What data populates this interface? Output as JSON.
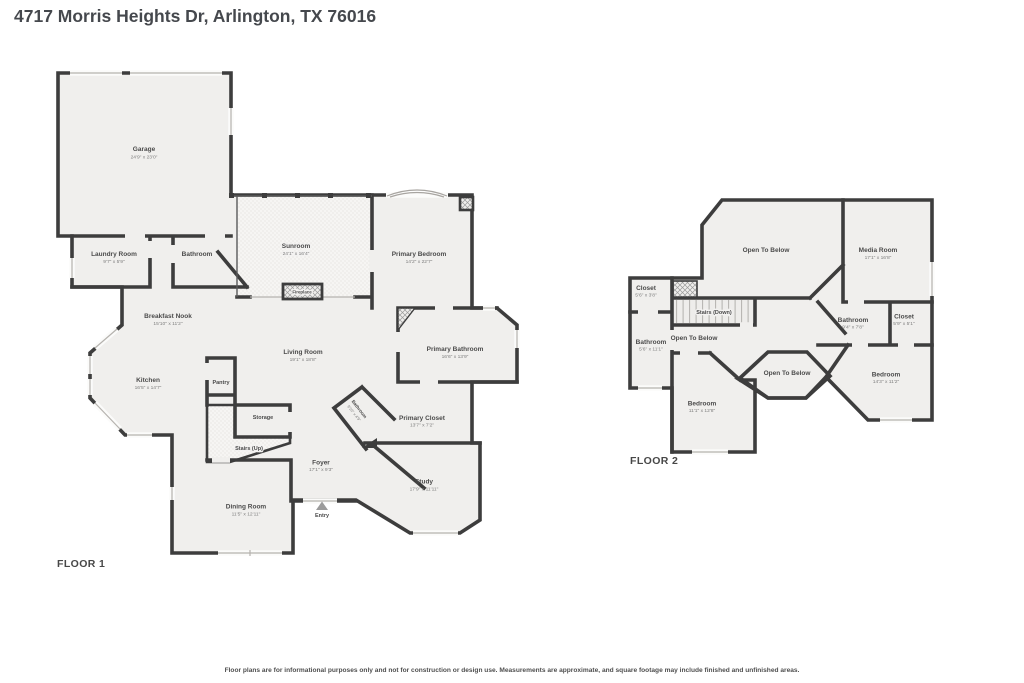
{
  "title": "4717 Morris Heights Dr, Arlington, TX 76016",
  "disclaimer": "Floor plans are for informational purposes only and not for construction or design use. Measurements are approximate, and square footage may include finished and unfinished areas.",
  "colors": {
    "wall": "#3d3d3d",
    "room_fill": "#f0efed",
    "title_text": "#45484d",
    "label_text": "#4b4b4b",
    "dims_text": "#7d7d7d"
  },
  "floor1": {
    "label": "FLOOR 1",
    "rooms": {
      "garage": {
        "name": "Garage",
        "dims": "24'9\" x 23'0\""
      },
      "laundry": {
        "name": "Laundry Room",
        "dims": "9'7\" x 5'9\""
      },
      "bathroom": {
        "name": "Bathroom"
      },
      "sunroom": {
        "name": "Sunroom",
        "dims": "24'1\" x 16'4\""
      },
      "primary_bedroom": {
        "name": "Primary Bedroom",
        "dims": "14'2\" x 22'7\""
      },
      "fireplace": {
        "name": "Fireplace"
      },
      "breakfast_nook": {
        "name": "Breakfast Nook",
        "dims": "15'10\" x 11'2\""
      },
      "living_room": {
        "name": "Living Room",
        "dims": "19'1\" x 18'8\""
      },
      "primary_bathroom": {
        "name": "Primary Bathroom",
        "dims": "16'6\" x 13'9\""
      },
      "kitchen": {
        "name": "Kitchen",
        "dims": "16'5\" x 14'7\""
      },
      "pantry": {
        "name": "Pantry"
      },
      "storage": {
        "name": "Storage"
      },
      "primary_closet": {
        "name": "Primary Closet",
        "dims": "13'7\" x 7'2\""
      },
      "bathroom2": {
        "name": "Bathroom",
        "dims": "9'10\" x 4'9\""
      },
      "stairs": {
        "name": "Stairs (Up)"
      },
      "foyer": {
        "name": "Foyer",
        "dims": "17'1\" x 9'3\""
      },
      "dining_room": {
        "name": "Dining Room",
        "dims": "11'5\" x 12'11\""
      },
      "entry": {
        "name": "Entry"
      },
      "study": {
        "name": "Study",
        "dims": "17'9\" x 11'11\""
      }
    }
  },
  "floor2": {
    "label": "FLOOR 2",
    "rooms": {
      "open_below_1": {
        "name": "Open To Below"
      },
      "media_room": {
        "name": "Media Room",
        "dims": "17'1\" x 16'8\""
      },
      "closet_left": {
        "name": "Closet",
        "dims": "5'6\" x 3'8\""
      },
      "stairs": {
        "name": "Stairs (Down)"
      },
      "bathroom_right": {
        "name": "Bathroom",
        "dims": "9'4\" x 7'8\""
      },
      "closet_right": {
        "name": "Closet",
        "dims": "5'9\" x 5'1\""
      },
      "bathroom_left": {
        "name": "Bathroom",
        "dims": "5'6\" x 11'1\""
      },
      "open_below_2": {
        "name": "Open To Below"
      },
      "open_below_3": {
        "name": "Open To Below"
      },
      "bedroom_left": {
        "name": "Bedroom",
        "dims": "11'1\" x 12'8\""
      },
      "bedroom_right": {
        "name": "Bedroom",
        "dims": "14'3\" x 11'2\""
      }
    }
  }
}
